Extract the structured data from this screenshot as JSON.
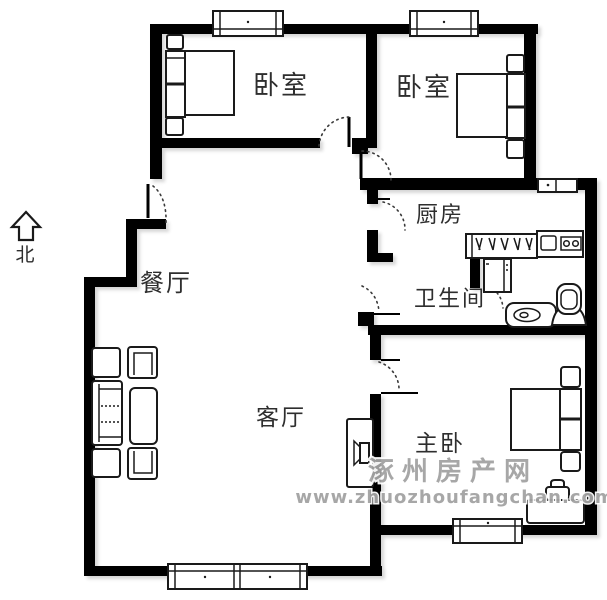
{
  "compass": {
    "label": "北"
  },
  "rooms": {
    "bedroom_top_left": "卧室",
    "bedroom_top_right": "卧室",
    "kitchen": "厨房",
    "bathroom": "卫生间",
    "dining_room": "餐厅",
    "living_room": "客厅",
    "master_bedroom": "主卧"
  },
  "watermark": {
    "site_name": "涿州房产网",
    "site_url": "www.zhuozhoufangchan.com"
  },
  "colors": {
    "wall": "#000000",
    "label_text": "#2e2e2e",
    "watermark_text": "#a3a3a3",
    "background": "#ffffff"
  }
}
